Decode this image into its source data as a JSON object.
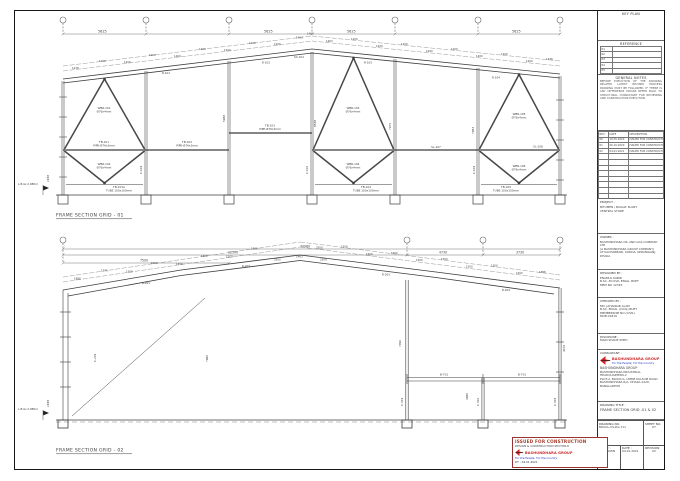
{
  "pd": {
    "a": "1200",
    "b": "1438",
    "c": "1463",
    "d": "1500",
    "e": "1888",
    "f": "1770",
    "g": "2500"
  },
  "top_frame": {
    "title": "FRAME SECTION GRID - 01",
    "ground": "L.B.Gr.2.980m",
    "dims": {
      "span": "5625",
      "v1": "8538",
      "v2": "5988",
      "v3": "7975",
      "v4": "7983",
      "v5": "2438",
      "apex": "1463"
    },
    "members": {
      "wbr101": "WBR-101",
      "wbr102": "WBR-102",
      "wbr103": "WBR-103",
      "wbr104": "WBR-104",
      "wbr105": "WBR-105",
      "wbr106": "WBR-106",
      "tb101": "TB-101",
      "tb101a": "TB-101A",
      "tb102": "TB-102",
      "tb103": "TB-103",
      "tb104": "TB-104",
      "tb105": "TB-105",
      "sl107": "SL-107",
      "sl108": "SL-108",
      "pipe": "PIPE-Ø76x3mm",
      "rod": "Ø76x4mm",
      "tube": "TUBE 100x100mm",
      "r1": "R-101",
      "r2": "R-102",
      "r3": "R-103",
      "r4": "R-104",
      "sc": "SC-101",
      "c1": "C-101",
      "c2": "C-102",
      "c3": "C-103"
    }
  },
  "bottom_frame": {
    "title": "FRAME SECTION GRID - 02",
    "ground": "L.B.Gr.2.980m",
    "dims": {
      "total": "30960",
      "left": "22500",
      "sub": "7500",
      "m1": "4730",
      "m2": "3730",
      "v1": "7980",
      "v2": "7090",
      "v3": "3980",
      "v4": "4078",
      "v5": "2438",
      "apex": "1463",
      "g1": "2500"
    },
    "members": {
      "r1": "R-201",
      "r2": "R-202",
      "r3": "R-203",
      "r4": "R-204",
      "c1": "C-201",
      "c2": "C-202",
      "b1": "B-701",
      "mc1": "C-301",
      "mc2": "C-302",
      "mc3": "C-303"
    }
  },
  "stamp": {
    "line1": "ISSUED FOR CONSTRUCTION",
    "line2": "DESIGN & CONSTRUCTION SECTOR-8",
    "brand": "BASHUNDHARA GROUP",
    "tagline": "For the People, For the Country",
    "date": "DT : 04.01.2021"
  },
  "titleblock": {
    "key_plan": "KEY PLAN",
    "reference": {
      "label": "REFERENCE",
      "rows": [
        "R1",
        "R2",
        "R3",
        "R4",
        "R5"
      ]
    },
    "notes": {
      "label": "GENERAL NOTES",
      "body": "BEFORE EXECUTION OF THE DRAWING RELATED LATEST REVISED PROCESS DRAWING MUST BE FOLLOWED. IF THERE IS ANY DIFFERENCE PLEASE REFER BACK TO STRUCTURAL CONSULTANT FOR REVIEWING AND CONSTRUCTION EXECUTION."
    },
    "revisions": {
      "headers": {
        "rev": "REV",
        "date": "DATE",
        "desc": "DESCRIPTION"
      },
      "rows": [
        {
          "rev": "00",
          "date": "10.05.2020",
          "desc": "ISSUED FOR CONSTRUCTION"
        },
        {
          "rev": "01",
          "date": "06.10.2020",
          "desc": "ISSUED FOR CONSTRUCTION"
        },
        {
          "rev": "02",
          "date": "04.01.2021",
          "desc": "ISSUED FOR CONSTRUCTION"
        }
      ]
    },
    "project": {
      "label": "PROJECT :",
      "line1": "BITUMEN / BASALT PLANT",
      "line2": "CENTRAL STORE"
    },
    "owner": {
      "label": "OWNER :",
      "line1": "BASHUNDHARA OIL AND GAS COMPANY LTD",
      "line2": "(A BASHUNDHARA GROUP COMPANY)",
      "line3": "AT KACHARBARI, KODDA, KERANIGANJ, DHAKA"
    },
    "designed": {
      "label": "DESIGNED BY :",
      "line1": "ENAMUL KABIR",
      "line2": "B.SC. IN CIVIL ENGG. BUET",
      "line3": "MEM NO 12345"
    },
    "checked": {
      "label": "CHECKED BY :",
      "line1": "MD. JAHANGIR ALAM",
      "line2": "B.SC. ENGG. (CIVIL) BUET",
      "line3": "MEMBERSHIP NO (CIVIL)",
      "line4": "MOB 01819"
    },
    "discipline": {
      "label": "DISCIPLINE :",
      "value": "MAIN SHADE SHED"
    },
    "consultant": {
      "label": "CONSULTANT :",
      "brand": "BASHUNDHARA GROUP",
      "tagline": "For the People, For the Country",
      "company": "BASHUNDHARA GROUP",
      "addr1": "BASHUNDHARA INDUSTRIAL HEADQUARTERS-2",
      "addr2": "PLOT-2, BLOCK-G, UMME KULSUM ROAD",
      "addr3": "BASHUNDHARA R/A, DHAKA-1229, BANGLADESH"
    },
    "drawing_title": {
      "label": "DRAWING TITLE :",
      "value": "FRAME SECTION GRID -01 & 02"
    },
    "meta": {
      "drawing_no_label": "DRAWING NO.",
      "drawing_no": "BOGCL-CS-DG-711",
      "sheet_label": "SHEET NO.",
      "sheet": "07",
      "scale_label": "SCALE :",
      "scale": "AS SHOWN",
      "date_label": "DATE :",
      "date": "04.01.2021",
      "rev_label": "REVISION",
      "rev": "02"
    }
  }
}
